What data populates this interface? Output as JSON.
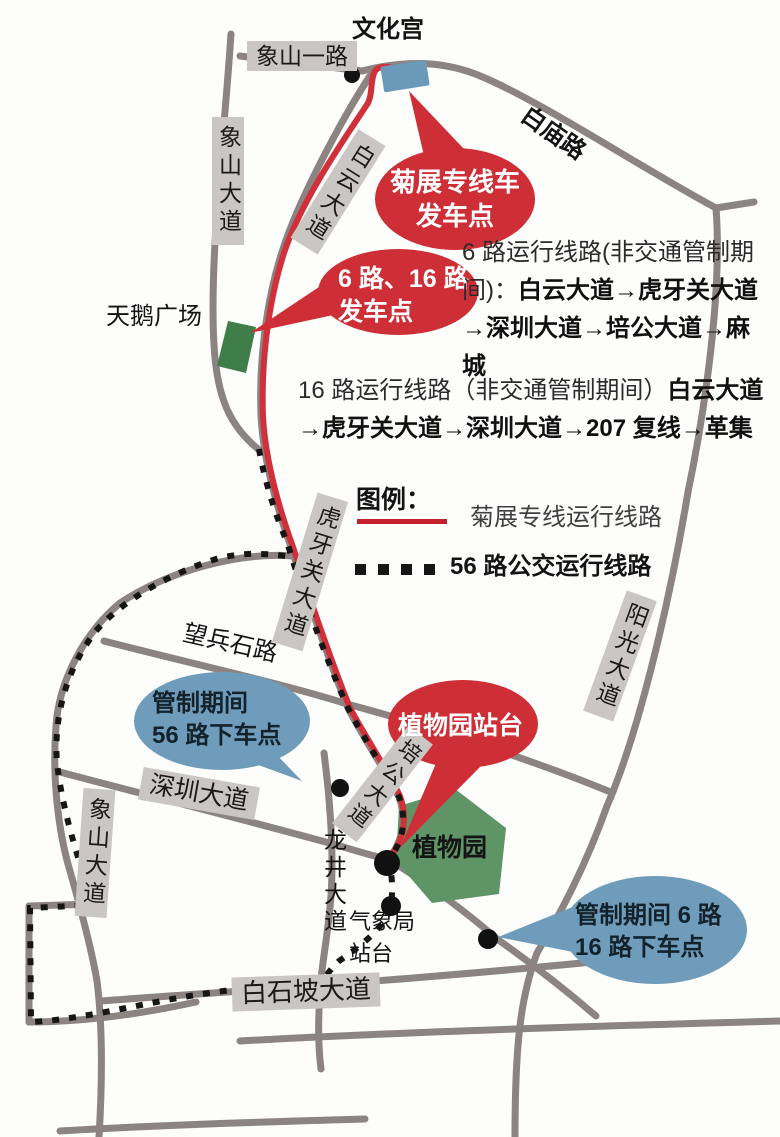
{
  "places": {
    "cultural_palace": "文化宫",
    "swan_plaza": "天鹅广场",
    "botanical_garden": "植物园",
    "weather_bureau_line1": "气象局",
    "weather_bureau_line2": "站台",
    "baimiao_road": "白庙路",
    "wangbingshi_road": "望兵石路",
    "longjing_avenue": "龙井大道"
  },
  "road_labels": {
    "xiangshan_first_road": "象山一路",
    "xiangshan_avenue_north": "象山大道",
    "baiyun_avenue": "白云大道",
    "huyaguan_avenue": "虎牙关大道",
    "yangguang_avenue": "阳光大道",
    "shenzhen_avenue": "深圳大道",
    "xiangshan_avenue_south": "象山大道",
    "peigong_avenue": "培公大道",
    "baishipo_avenue": "白石坡大道"
  },
  "balloons": {
    "departure_special": {
      "line1": "菊展专线车",
      "line2": "发车点"
    },
    "departure_6_16": {
      "line1": "6 路、16 路",
      "line2": "发车点"
    },
    "botanical_platform": {
      "line1": "植物园站台"
    },
    "dropoff_56": {
      "line1": "管制期间",
      "line2": "56 路下车点"
    },
    "dropoff_6_16": {
      "line1": "管制期间 6 路",
      "line2": "16 路下车点"
    }
  },
  "notes": {
    "route6_prefix": "6 路运行线路(非交通管制期间)：",
    "route6_route": "白云大道→虎牙关大道→深圳大道→培公大道→麻城",
    "route16_prefix": "16 路运行线路（非交通管制期间）",
    "route16_route": "白云大道→虎牙关大道→深圳大道→207 复线→革集"
  },
  "legend": {
    "title": "图例：",
    "special_line_label": "菊展专线运行线路",
    "bus56_label": "56 路公交运行线路"
  },
  "colors": {
    "road": "#8b8482",
    "special_line_red": "#d0303a",
    "bus56_black": "#161616",
    "label_box_bg": "#c9c6c3",
    "balloon_red": "#ce2e36",
    "balloon_blue": "#6f9cba",
    "departure_marker_blue": "#6b9ab8",
    "plaza_green": "#3f7d49",
    "garden_green": "#5e9466"
  }
}
